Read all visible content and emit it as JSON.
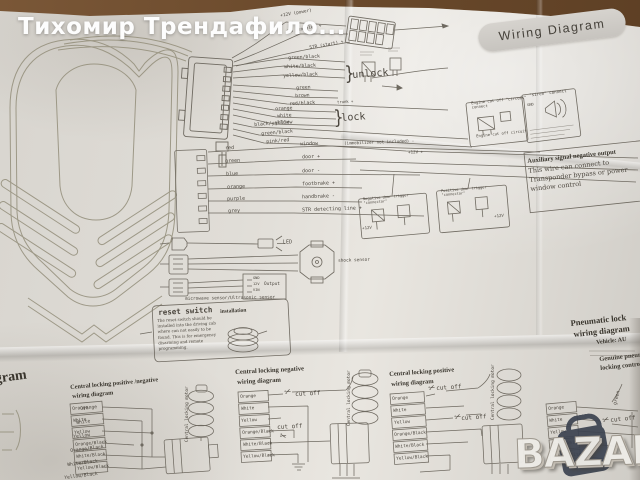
{
  "overlay": {
    "listing_title": "Тихомир Трендафило...",
    "watermark_text": "BAZAR"
  },
  "badge": {
    "label": "Wiring Diagram"
  },
  "main_unit": {
    "top_wires": [
      "+12V (power)",
      "IG (enable) +",
      "STR (start) +"
    ],
    "unlock_wires": [
      "green/black",
      "white/black",
      "yellow/black"
    ],
    "unlock_label": "unlock",
    "brace": "}",
    "lock_wires": [
      "green",
      "brown",
      "red/black",
      "orange",
      "white",
      "yellow"
    ],
    "lock_label": "lock",
    "trunk_label": "trunk +",
    "aux_wires": [
      "black/yellow",
      "green/black",
      "pink/red"
    ],
    "immobilizer_note": "(immobilizer not included) -",
    "power_note": "+12V +"
  },
  "io_rows": [
    {
      "color": "red",
      "function": "window"
    },
    {
      "color": "green",
      "function": "door +"
    },
    {
      "color": "blue",
      "function": "door -"
    },
    {
      "color": "orange",
      "function": "footbrake +"
    },
    {
      "color": "purple",
      "function": "handbrake -"
    },
    {
      "color": "grey",
      "function": "STR detecting line +"
    }
  ],
  "accessories": {
    "led_label": "LED",
    "shock_label": "shock sensor",
    "output_pins": [
      "GND",
      "12V",
      "VIN"
    ],
    "output_label": "Output",
    "sensor_caption": "microwave sensor/Ultrasonic sensor"
  },
  "reset_switch": {
    "title": "reset switch",
    "subtitle": "installation",
    "lines": [
      "The reset switch should be",
      "installed into the driving cab",
      "where can not easily to be",
      "found. This is for emergency",
      "disarming and remote",
      "programming."
    ]
  },
  "connect_boxes": {
    "engine_title": "Engine cut off \"circuit\" connect",
    "engine_caption": "Engine cut off circuit",
    "siren_title": "\"siren\" connect",
    "siren_gnd": "GND",
    "trigger_neg_title": "Negative door trigger \"connector\"",
    "trigger_pos_title": "Positive door trigger \"connector\"",
    "plus12v": "+12V"
  },
  "aux_output": {
    "lines": [
      "Auxiliary signal negative output",
      "This wire can connect to",
      "Transponder bypass or power",
      "window control"
    ]
  },
  "pneumatic": {
    "title1": "Pneumatic lock",
    "title2": "wiring diagram",
    "vehicle": "Vehicle: AU",
    "genuine1": "Genuine pneumatic",
    "genuine2": "locking control"
  },
  "bottom": {
    "partial_title": "gram",
    "left_legend": [
      "Orange",
      "White",
      "Yellow",
      "Orange/Black",
      "White/Black",
      "Yellow/Black"
    ],
    "motor_label": "Central locking motor",
    "cutoff_label": "cut off",
    "scissors": "✂",
    "d1": {
      "title1": "Central locking positive /negative",
      "title2": "wiring diagram",
      "wires": [
        "Orange",
        "White",
        "Yellow",
        "Orange/Black",
        "White/Black",
        "Yellow/Black"
      ]
    },
    "d2": {
      "title1": "Central locking negative",
      "title2": "wiring diagram",
      "wires": [
        "Orange",
        "White",
        "Yellow",
        "Orange/Black",
        "White/Black",
        "Yellow/Black"
      ]
    },
    "d3": {
      "title1": "Central locking positive",
      "title2": "wiring diagram",
      "wires": [
        "Orange",
        "White",
        "Yellow",
        "Orange/Black",
        "White/Black",
        "Yellow/Black"
      ]
    },
    "d4": {
      "wires": [
        "Orange",
        "White",
        "Yellow",
        "Green/White",
        "Black/White"
      ],
      "green_label": "green"
    }
  }
}
